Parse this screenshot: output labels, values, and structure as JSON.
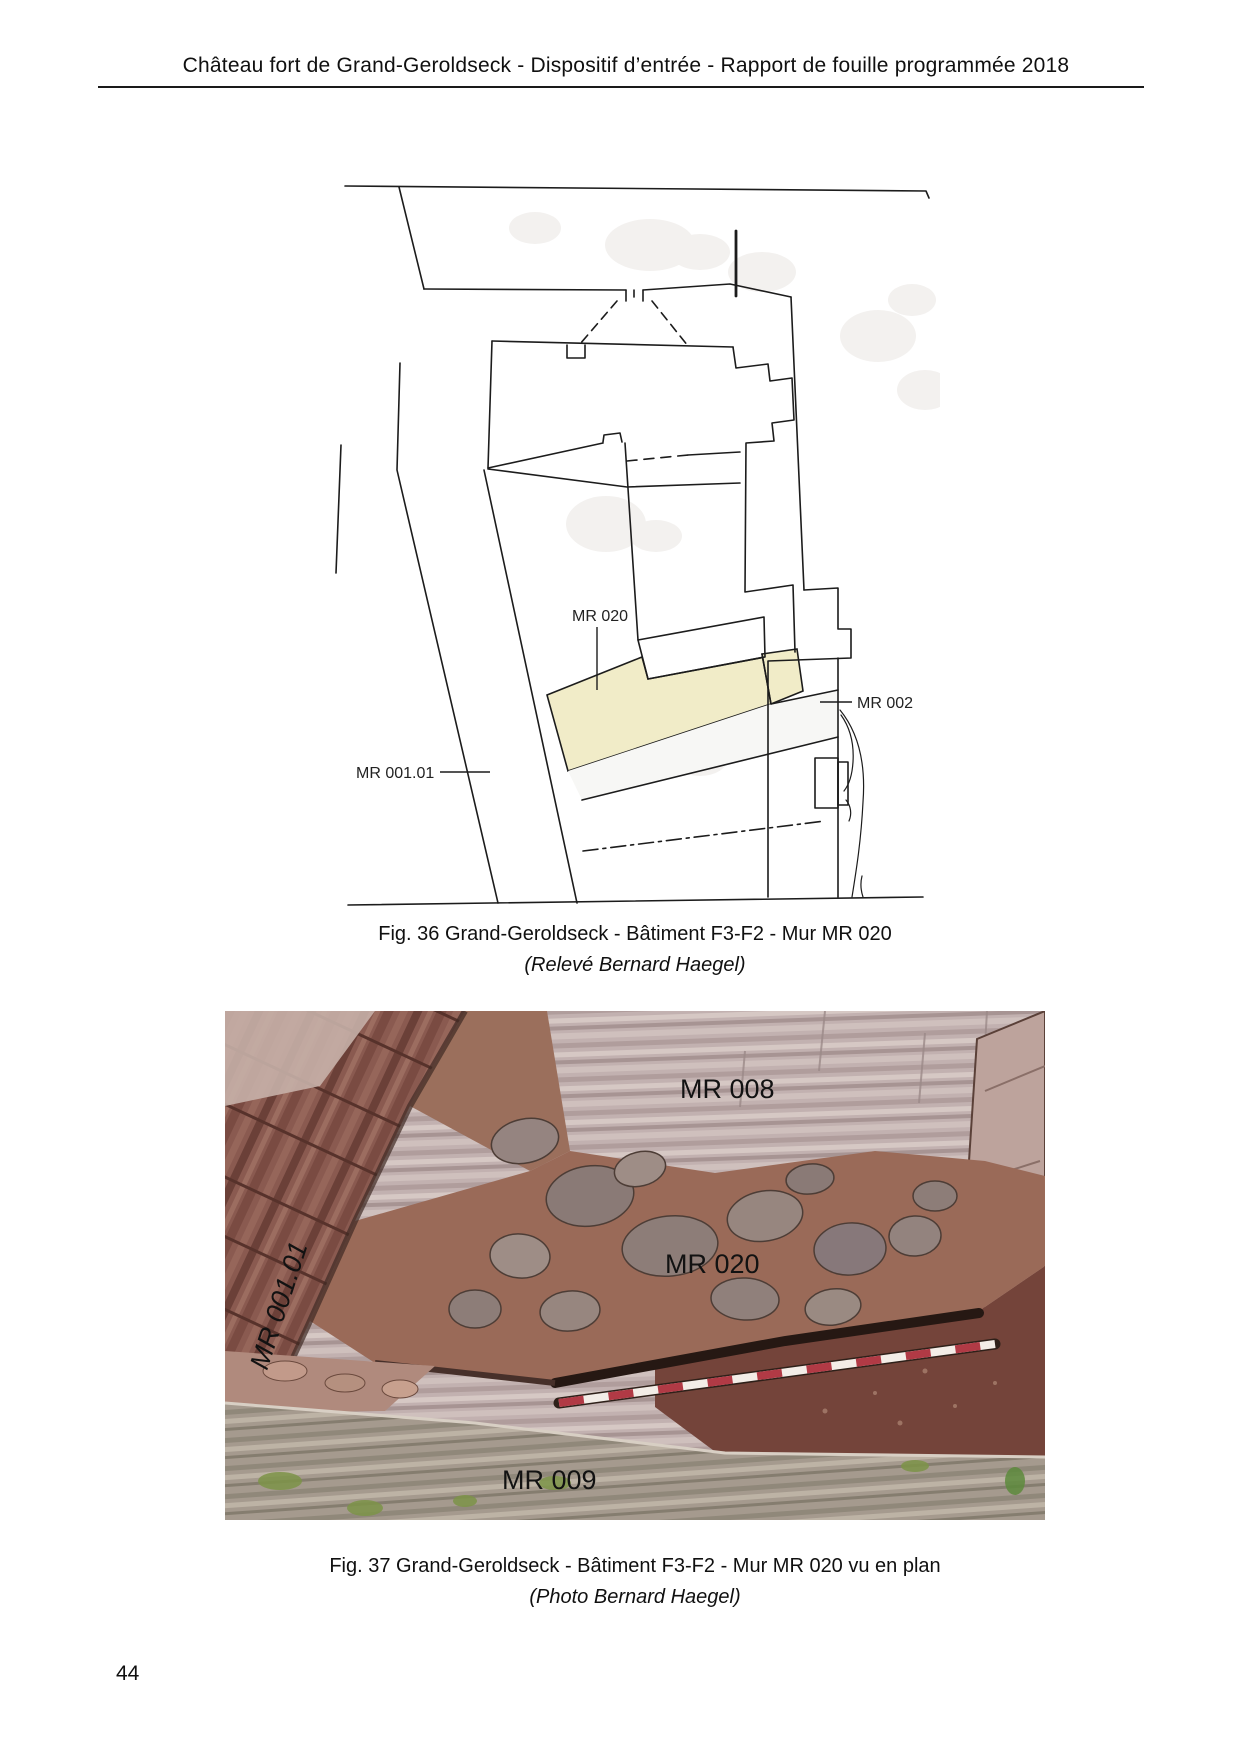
{
  "header": {
    "title": "Château fort de Grand-Geroldseck - Dispositif d’entrée - Rapport de fouille programmée 2018"
  },
  "figure36": {
    "type": "archaeological plan drawing",
    "labels": {
      "mr020": "MR 020",
      "mr001_01": "MR 001.01",
      "mr002": "MR 002"
    },
    "caption_line1": "Fig. 36 Grand-Geroldseck - Bâtiment F3-F2 - Mur MR 020",
    "caption_line2": "(Relevé Bernard Haegel)",
    "highlight_color": "#f1ecc8"
  },
  "figure37": {
    "type": "excavation photograph",
    "labels": {
      "mr008": "MR 008",
      "mr001_01": "MR 001.01",
      "mr020": "MR 020",
      "mr009": "MR 009"
    },
    "caption_line1": "Fig. 37 Grand-Geroldseck - Bâtiment F3-F2 - Mur MR 020 vu en plan",
    "caption_line2": "(Photo Bernard Haegel)",
    "pole_red": "#b13a45",
    "pole_white": "#f3ede7"
  },
  "page_number": "44"
}
